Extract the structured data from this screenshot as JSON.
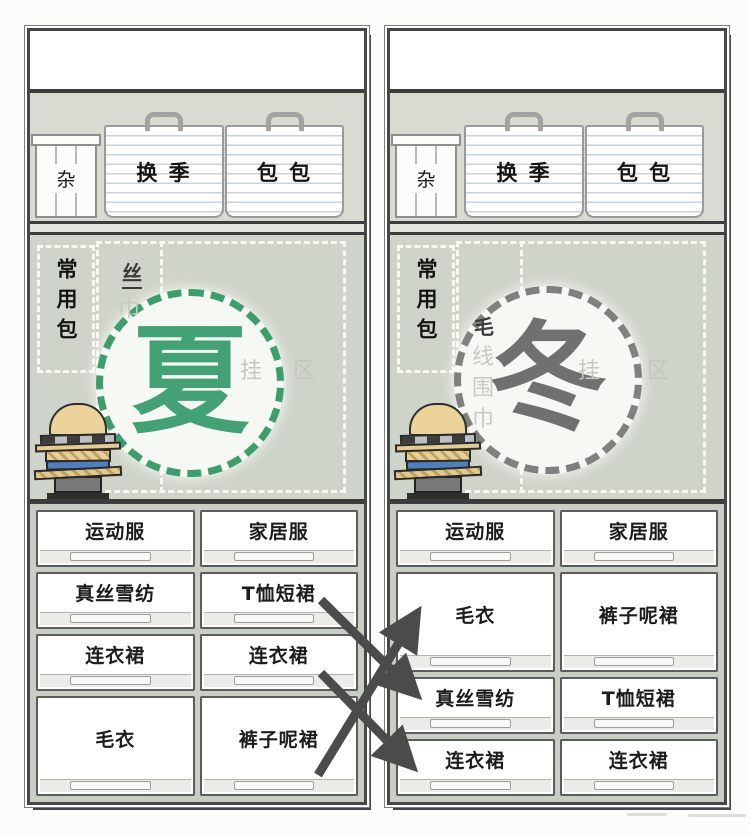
{
  "closets": [
    {
      "season": {
        "label": "夏",
        "char_color": "#43a176",
        "dot_color": "#3d9e6d"
      },
      "top_shelf_boxes": [
        {
          "label": "杂"
        },
        {
          "label": "换 季"
        },
        {
          "label": "包 包"
        }
      ],
      "hanging_area": {
        "bags_zone_label": "常用包",
        "scarf_label_top": "丝",
        "scarf_label_rest": [
          "巾"
        ],
        "hanging_zone_label": "挂 区"
      },
      "drawer_rows": [
        {
          "tall": false,
          "cells": [
            "运动服",
            "家居服"
          ]
        },
        {
          "tall": false,
          "cells": [
            "真丝雪纺",
            "T恤短裙"
          ]
        },
        {
          "tall": false,
          "cells": [
            "连衣裙",
            "连衣裙"
          ]
        },
        {
          "tall": true,
          "cells": [
            "毛衣",
            "裤子呢裙"
          ]
        }
      ]
    },
    {
      "season": {
        "label": "冬",
        "char_color": "#6e716e",
        "dot_color": "#7e817d"
      },
      "top_shelf_boxes": [
        {
          "label": "杂"
        },
        {
          "label": "换 季"
        },
        {
          "label": "包 包"
        }
      ],
      "hanging_area": {
        "bags_zone_label": "常用包",
        "scarf_label_top": "毛",
        "scarf_label_rest": [
          "线",
          "围",
          "巾"
        ],
        "hanging_zone_label": "挂 区"
      },
      "drawer_rows": [
        {
          "tall": false,
          "cells": [
            "运动服",
            "家居服"
          ]
        },
        {
          "tall": true,
          "cells": [
            "毛衣",
            "裤子呢裙"
          ]
        },
        {
          "tall": false,
          "cells": [
            "真丝雪纺",
            "T恤短裙"
          ]
        },
        {
          "tall": false,
          "cells": [
            "连衣裙",
            "连衣裙"
          ]
        }
      ]
    }
  ],
  "colors": {
    "shelf_bg": "#d7dbd1",
    "hang_bg": "#ced4c9",
    "drawer_area_bg": "#c9cec5",
    "arrow": "#4b4b4b",
    "box_stripe": "#c8d3db"
  }
}
